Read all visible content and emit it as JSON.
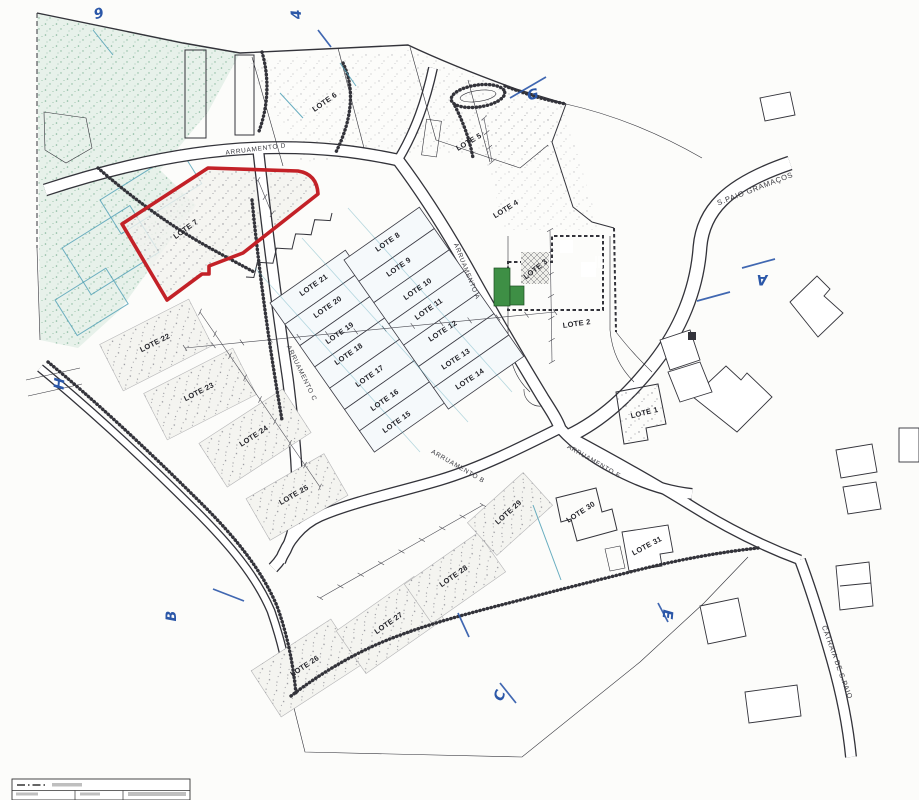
{
  "plan": {
    "type": "allotment-site-plan",
    "highlighted_lot": "LOTE 7",
    "colors": {
      "paper": "#fcfcfa",
      "ink": "#33333a",
      "red": "#c32127",
      "blue": "#2b57a8",
      "teal": "#4d9fb5",
      "veg_fill": "#e7f1ea",
      "veg_dot": "#88b89d",
      "dark_building": "#515157",
      "landscape_green": "#3e8f45",
      "stipple_dot": "#8f8f96"
    },
    "lots": [
      {
        "t": "LOTE 1",
        "x": 645,
        "y": 415,
        "r": -14
      },
      {
        "t": "LOTE 2",
        "x": 577,
        "y": 326,
        "r": -8
      },
      {
        "t": "LOTE 3",
        "x": 537,
        "y": 271,
        "r": -38
      },
      {
        "t": "LOTE 4",
        "x": 507,
        "y": 211,
        "r": -32
      },
      {
        "t": "LOTE 5",
        "x": 470,
        "y": 144,
        "r": -30
      },
      {
        "t": "LOTE 6",
        "x": 326,
        "y": 104,
        "r": -35
      },
      {
        "t": "LOTE 7",
        "x": 187,
        "y": 231,
        "r": -36
      },
      {
        "t": "LOTE 8",
        "x": 389,
        "y": 244,
        "r": -35
      },
      {
        "t": "LOTE 9",
        "x": 400,
        "y": 269,
        "r": -35
      },
      {
        "t": "LOTE 10",
        "x": 419,
        "y": 291,
        "r": -35
      },
      {
        "t": "LOTE 11",
        "x": 430,
        "y": 311,
        "r": -35
      },
      {
        "t": "LOTE 12",
        "x": 444,
        "y": 333,
        "r": -33
      },
      {
        "t": "LOTE 13",
        "x": 457,
        "y": 361,
        "r": -33
      },
      {
        "t": "LOTE 14",
        "x": 471,
        "y": 381,
        "r": -33
      },
      {
        "t": "LOTE 15",
        "x": 398,
        "y": 424,
        "r": -35
      },
      {
        "t": "LOTE 16",
        "x": 386,
        "y": 402,
        "r": -35
      },
      {
        "t": "LOTE 17",
        "x": 371,
        "y": 378,
        "r": -35
      },
      {
        "t": "LOTE 18",
        "x": 350,
        "y": 356,
        "r": -35
      },
      {
        "t": "LOTE 19",
        "x": 341,
        "y": 335,
        "r": -35
      },
      {
        "t": "LOTE 20",
        "x": 329,
        "y": 309,
        "r": -35
      },
      {
        "t": "LOTE 21",
        "x": 315,
        "y": 287,
        "r": -35
      },
      {
        "t": "LOTE 22",
        "x": 156,
        "y": 345,
        "r": -27
      },
      {
        "t": "LOTE 23",
        "x": 200,
        "y": 394,
        "r": -27
      },
      {
        "t": "LOTE 24",
        "x": 255,
        "y": 438,
        "r": -33
      },
      {
        "t": "LOTE 25",
        "x": 295,
        "y": 497,
        "r": -30
      },
      {
        "t": "LOTE 26",
        "x": 306,
        "y": 668,
        "r": -33
      },
      {
        "t": "LOTE 27",
        "x": 390,
        "y": 625,
        "r": -35
      },
      {
        "t": "LOTE 28",
        "x": 455,
        "y": 578,
        "r": -35
      },
      {
        "t": "LOTE 29",
        "x": 510,
        "y": 514,
        "r": -42
      },
      {
        "t": "LOTE 30",
        "x": 582,
        "y": 514,
        "r": -33
      },
      {
        "t": "LOTE 31",
        "x": 648,
        "y": 548,
        "r": -28
      }
    ],
    "road_labels": [
      {
        "t": "ARRUAMENTO D",
        "x": 256,
        "y": 151,
        "r": -7,
        "s": 6.5
      },
      {
        "t": "ARRUAMENTO A",
        "x": 465,
        "y": 272,
        "r": 68,
        "s": 6.5
      },
      {
        "t": "ARRUAMENTO C",
        "x": 300,
        "y": 374,
        "r": 64,
        "s": 6.5
      },
      {
        "t": "ARRUAMENTO B",
        "x": 457,
        "y": 468,
        "r": 30,
        "s": 6.5
      },
      {
        "t": "ARRUAMENTO E",
        "x": 593,
        "y": 463,
        "r": 30,
        "s": 6.5
      },
      {
        "t": "S.PAIO GRAMAÇOS",
        "x": 756,
        "y": 191,
        "r": -21,
        "s": 7.5
      },
      {
        "t": "CATRAIA DE S.PAIO",
        "x": 835,
        "y": 663,
        "r": 70,
        "s": 7
      }
    ],
    "markers": [
      {
        "t": "9",
        "x": 100,
        "y": 18,
        "r": -15
      },
      {
        "t": "4",
        "x": 301,
        "y": 14,
        "r": -95
      },
      {
        "t": "G",
        "x": 534,
        "y": 99,
        "r": -15
      },
      {
        "t": "A",
        "x": 762,
        "y": 275,
        "r": 180
      },
      {
        "t": "H",
        "x": 64,
        "y": 384,
        "r": -85
      },
      {
        "t": "B",
        "x": 176,
        "y": 616,
        "r": -90
      },
      {
        "t": "C",
        "x": 504,
        "y": 697,
        "r": -70
      },
      {
        "t": "E",
        "x": 663,
        "y": 614,
        "r": 95
      }
    ]
  }
}
